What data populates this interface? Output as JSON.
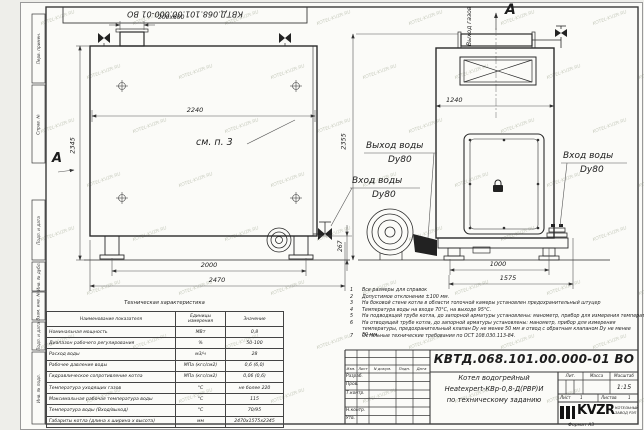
{
  "sheet": {
    "top_stamp": "КВТД.068.101.00.000-01  ВО",
    "format_note": "Формат  А3",
    "watermark_text": "KOTEL-KVZR.RU"
  },
  "frame_strips": [
    {
      "label": "Перв. примен."
    },
    {
      "label": "Справ. №"
    },
    {
      "label": "Подп. и дата"
    },
    {
      "label": "Инв. № дубл."
    },
    {
      "label": "Взам. инв. №"
    },
    {
      "label": "Подп. и дата"
    },
    {
      "label": "Инв. № подл."
    }
  ],
  "side_view": {
    "note_ref": "см. п. 3",
    "dim_chimney": "200x600",
    "dim_inner_width": "2240",
    "dim_height": "2345",
    "dim_base_width": "2000",
    "dim_overall_width": "2470",
    "view_arrow_label": "А"
  },
  "front_view": {
    "view_label": "А",
    "gas_outlet_label": "Выход газов",
    "dim_width": "1240",
    "dim_height": "2355",
    "dim_legs_height": "267",
    "dim_base_width": "1000",
    "dim_overall_width": "1575"
  },
  "pipe_labels": {
    "water_outlet_line1": "Выход воды",
    "water_outlet_line2": "Dy80",
    "water_inlet_line1": "Вход воды",
    "water_inlet_line2": "Dy80",
    "water_inlet_right_line1": "Вход воды",
    "water_inlet_right_line2": "Dy80"
  },
  "notes": [
    {
      "num": "1",
      "text": "Все размеры для справок"
    },
    {
      "num": "2",
      "text": "Допустимое отклонение ±100 мм."
    },
    {
      "num": "3",
      "text": "На боковой стене котла в области топочной камеры установлен предохранительный штуцер"
    },
    {
      "num": "4",
      "text": "Температура воды на входе 70°С, на выходе 95°С."
    },
    {
      "num": "5",
      "text": "На подводящей трубе котла, до запорной арматуры установлены: манометр, прибор для измерения температуры,"
    },
    {
      "num": "6",
      "text": "На отводящей трубе котла, до запорной арматуры установлены: манометр, прибор для измерения температуры, предохранительный клапан Dу не менее 50 мм и отвод с обратным клапаном Dу не менее 50 мм."
    },
    {
      "num": "7",
      "text": "Остальные технические требования по ОСТ 108.030.113-84."
    }
  ],
  "spec_table": {
    "title": "Техническая характеристика",
    "headers": [
      "Наименование показателя",
      "Единицы измерения",
      "Значение"
    ],
    "rows": [
      [
        "Номинальная мощность",
        "МВт",
        "0,8"
      ],
      [
        "Диапазон рабочего регулирования",
        "%",
        "50-100"
      ],
      [
        "Расход воды",
        "м3/ч",
        "28"
      ],
      [
        "Рабочее давление воды",
        "МПа (кгс/см2)",
        "0,6 (6,0)"
      ],
      [
        "Гидравлическое сопротивление котла",
        "МПа (кгс/см2)",
        "0,06 (0,6)"
      ],
      [
        "Температура уходящих газов",
        "°С",
        "не более 220"
      ],
      [
        "Максимальная рабочая температура воды",
        "°С",
        "115"
      ],
      [
        "Температура воды (Вход/выход)",
        "°С",
        "70/95"
      ],
      [
        "Габариты котла (длина х ширина х высота)",
        "мм",
        "2470х1575х2345"
      ]
    ]
  },
  "title_block": {
    "doc_number": "КВТД.068.101.00.000-01  ВО",
    "product_lines": [
      "Котел водогрейный",
      "Heatexpert-КВр-0,8-Д(РВР)И",
      "по техническому заданию"
    ],
    "sign_rows": [
      "Разраб.",
      "Пров.",
      "Т.контр.",
      "",
      "Н.контр.",
      "Утв."
    ],
    "header_cols": [
      "Изм.",
      "Лист",
      "N докум.",
      "Подп.",
      "Дата"
    ],
    "lit_label": "Лит.",
    "mass_label": "Масса",
    "scale_label": "Масштаб",
    "scale_value": "1:15",
    "sheet_label": "Лист",
    "sheet_value": "1",
    "sheets_label": "Листов",
    "sheets_value": "1",
    "logo_text": "KVZR",
    "logo_caption_line1": "КОТЕЛЬНЫЙ",
    "logo_caption_line2": "ЗАВОД РЭП"
  }
}
